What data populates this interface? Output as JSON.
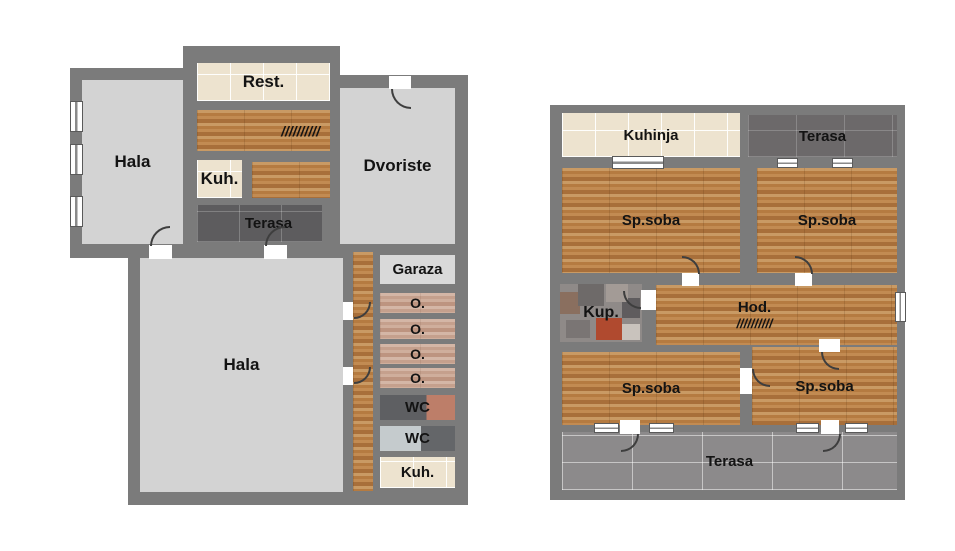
{
  "left": {
    "hala_top": "Hala",
    "rest": "Rest.",
    "stairs": "//////////",
    "kuh": "Kuh.",
    "terasa": "Terasa",
    "dvoriste": "Dvoriste",
    "hala_main": "Hala",
    "garaza": "Garaza",
    "o1": "O.",
    "o2": "O.",
    "o3": "O.",
    "o4": "O.",
    "wc1": "WC",
    "wc2": "WC",
    "kuh2": "Kuh."
  },
  "right": {
    "kuhinja": "Kuhinja",
    "terasa_top": "Terasa",
    "sp_tl": "Sp.soba",
    "sp_tr": "Sp.soba",
    "kup": "Kup.",
    "hod": "Hod.",
    "hod_stairs": "//////////",
    "sp_bl": "Sp.soba",
    "sp_br": "Sp.soba",
    "terasa_bottom": "Terasa"
  },
  "colors": {
    "wall": "#7b7b7b",
    "floor_light_gray": "#d3d3d3",
    "wood": "#b97e45",
    "wood_faded": "#c9a391",
    "tile_cream": "#ede3cf",
    "terrace_dark": "#5d5c5e",
    "terrace_gray": "#8c8a8b",
    "label_text": "#131313",
    "background": "#ffffff"
  }
}
